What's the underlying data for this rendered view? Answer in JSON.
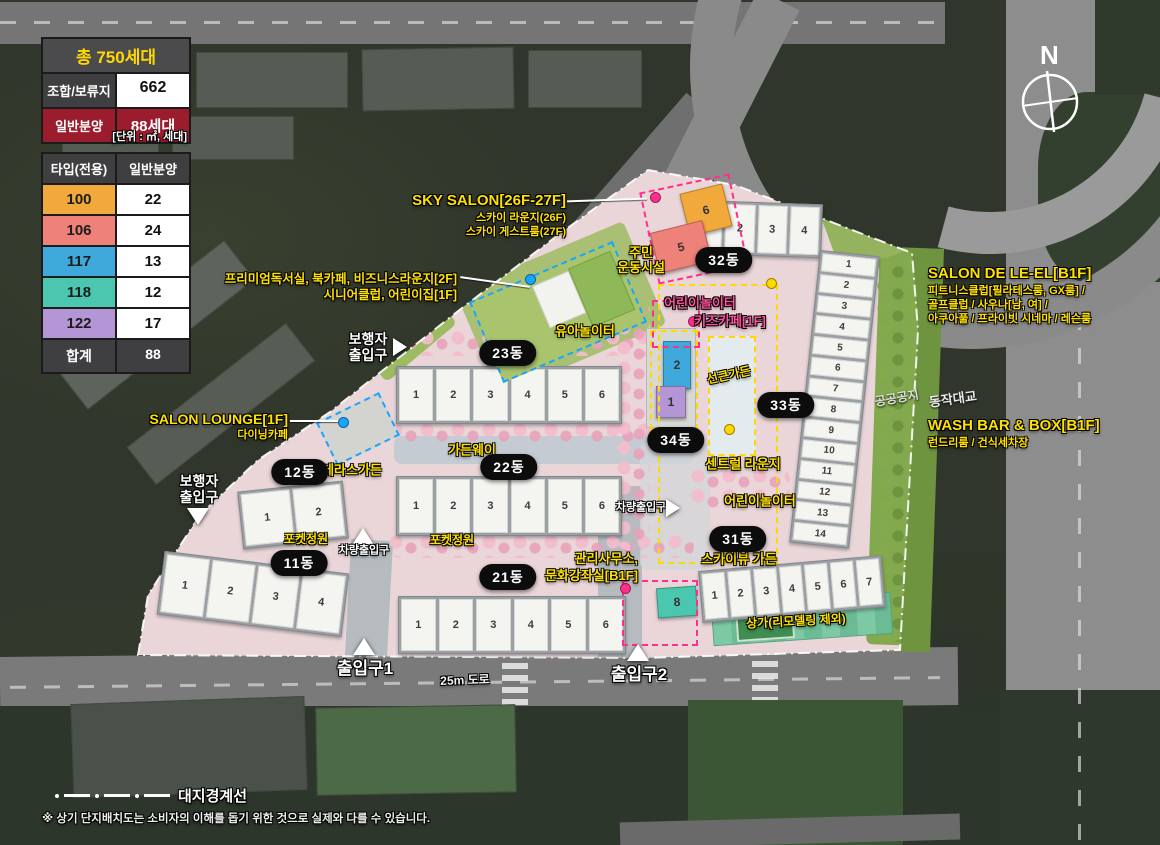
{
  "legend": {
    "total_table": {
      "title": "총 750세대",
      "rows": [
        {
          "label": "조합/보류지",
          "value": "662"
        },
        {
          "label": "일반분양",
          "value": "88세대"
        }
      ],
      "unit_note": "[단위 : ㎡, 세대]"
    },
    "type_table": {
      "col1": "타입(전용)",
      "col2": "일반분양",
      "rows": [
        {
          "type": "100",
          "count": "22",
          "color": "#F2A93B"
        },
        {
          "type": "106",
          "count": "24",
          "color": "#EE8178"
        },
        {
          "type": "117",
          "count": "13",
          "color": "#3FA9DC"
        },
        {
          "type": "118",
          "count": "12",
          "color": "#4BC7B0"
        },
        {
          "type": "122",
          "count": "17",
          "color": "#B495D6"
        }
      ],
      "total_label": "합계",
      "total_count": "88"
    }
  },
  "compass": {
    "north": "N"
  },
  "callouts": {
    "sky_salon": {
      "title": "SKY SALON[26F-27F]",
      "line1": "스카이 라운지(26F)",
      "line2": "스카이 게스트룸(27F)"
    },
    "premium": {
      "line1": "프리미엄독서실, 북카페, 비즈니스라운지[2F]",
      "line2": "시니어클럽, 어린이집[1F]"
    },
    "salon_lounge": {
      "title": "SALON LOUNGE[1F]",
      "line1": "다이닝카페"
    },
    "salon_de_leel": {
      "title": "SALON DE LE-EL[B1F]",
      "line1": "피트니스클럽[필라테스룸, GX룸] /",
      "line2": "골프클럽 / 사우나[남, 여] /",
      "line3": "아쿠아풀 / 프라이빗 시네마 / 레슨룸"
    },
    "wash_bar": {
      "title": "WASH BAR & BOX[B1F]",
      "line1": "런드리룸 / 건식세차장"
    },
    "management": {
      "line1": "관리사무소,",
      "line2": "문화강좌실[B1F]"
    }
  },
  "amenities": {
    "residents_sports": {
      "line1": "주민",
      "line2": "운동시설"
    },
    "kids_playground_pink": "어린이놀이터",
    "kids_cafe": "키즈카페[1F]",
    "toddler_playground": "유아놀이터",
    "terrace_garden": "테라스가든",
    "garden_way": "가든웨이",
    "pocket_garden1": "포켓정원",
    "pocket_garden2": "포켓정원",
    "sunken_garden": "선큰가든",
    "central_lounge": "센트럴 라운지",
    "kids_playground_yellow": "어린이놀이터",
    "skyview_garden": "스카이뷰 가든",
    "retail": "상가(리모델링 제외)"
  },
  "entrances": {
    "pedestrian1": {
      "line1": "보행자",
      "line2": "출입구"
    },
    "pedestrian2": {
      "line1": "보행자",
      "line2": "출입구"
    },
    "vehicle1": "차량출입구",
    "vehicle2": "차량출입구",
    "gate1": "출입구1",
    "gate2": "출입구2"
  },
  "roads": {
    "dongjak_bridge": "동작대교",
    "road_25m": "25m 도로",
    "public_open_space": "공공공지"
  },
  "buildings": {
    "b23": {
      "pill": "23동",
      "units": [
        "1",
        "2",
        "3",
        "4",
        "5",
        "6"
      ]
    },
    "b22": {
      "pill": "22동",
      "units": [
        "1",
        "2",
        "3",
        "4",
        "5",
        "6"
      ]
    },
    "b21": {
      "pill": "21동",
      "units": [
        "1",
        "2",
        "3",
        "4",
        "5",
        "6"
      ]
    },
    "b12": {
      "pill": "12동",
      "units": [
        "1",
        "2"
      ]
    },
    "b11": {
      "pill": "11동",
      "units": [
        "1",
        "2",
        "3",
        "4"
      ]
    },
    "b32": {
      "pill": "32동",
      "units": [
        "1",
        "2",
        "3",
        "4"
      ]
    },
    "b33": {
      "pill": "33동",
      "units": [
        "1",
        "2",
        "3",
        "4",
        "5",
        "6",
        "7",
        "8",
        "9",
        "10",
        "11",
        "12",
        "13",
        "14"
      ]
    },
    "b31": {
      "pill": "31동",
      "units": [
        "1",
        "2",
        "3",
        "4",
        "5",
        "6",
        "7"
      ],
      "unit8": "8"
    },
    "b34": {
      "pill": "34동",
      "unit2": "2",
      "unit1": "1"
    },
    "tower": {
      "unit6": "6",
      "unit5": "5"
    }
  },
  "footer": {
    "boundary_label": "대지경계선",
    "disclaimer": "※ 상기 단지배치도는 소비자의 이해를 돕기 위한 것으로 실제와 다를 수 있습니다."
  }
}
